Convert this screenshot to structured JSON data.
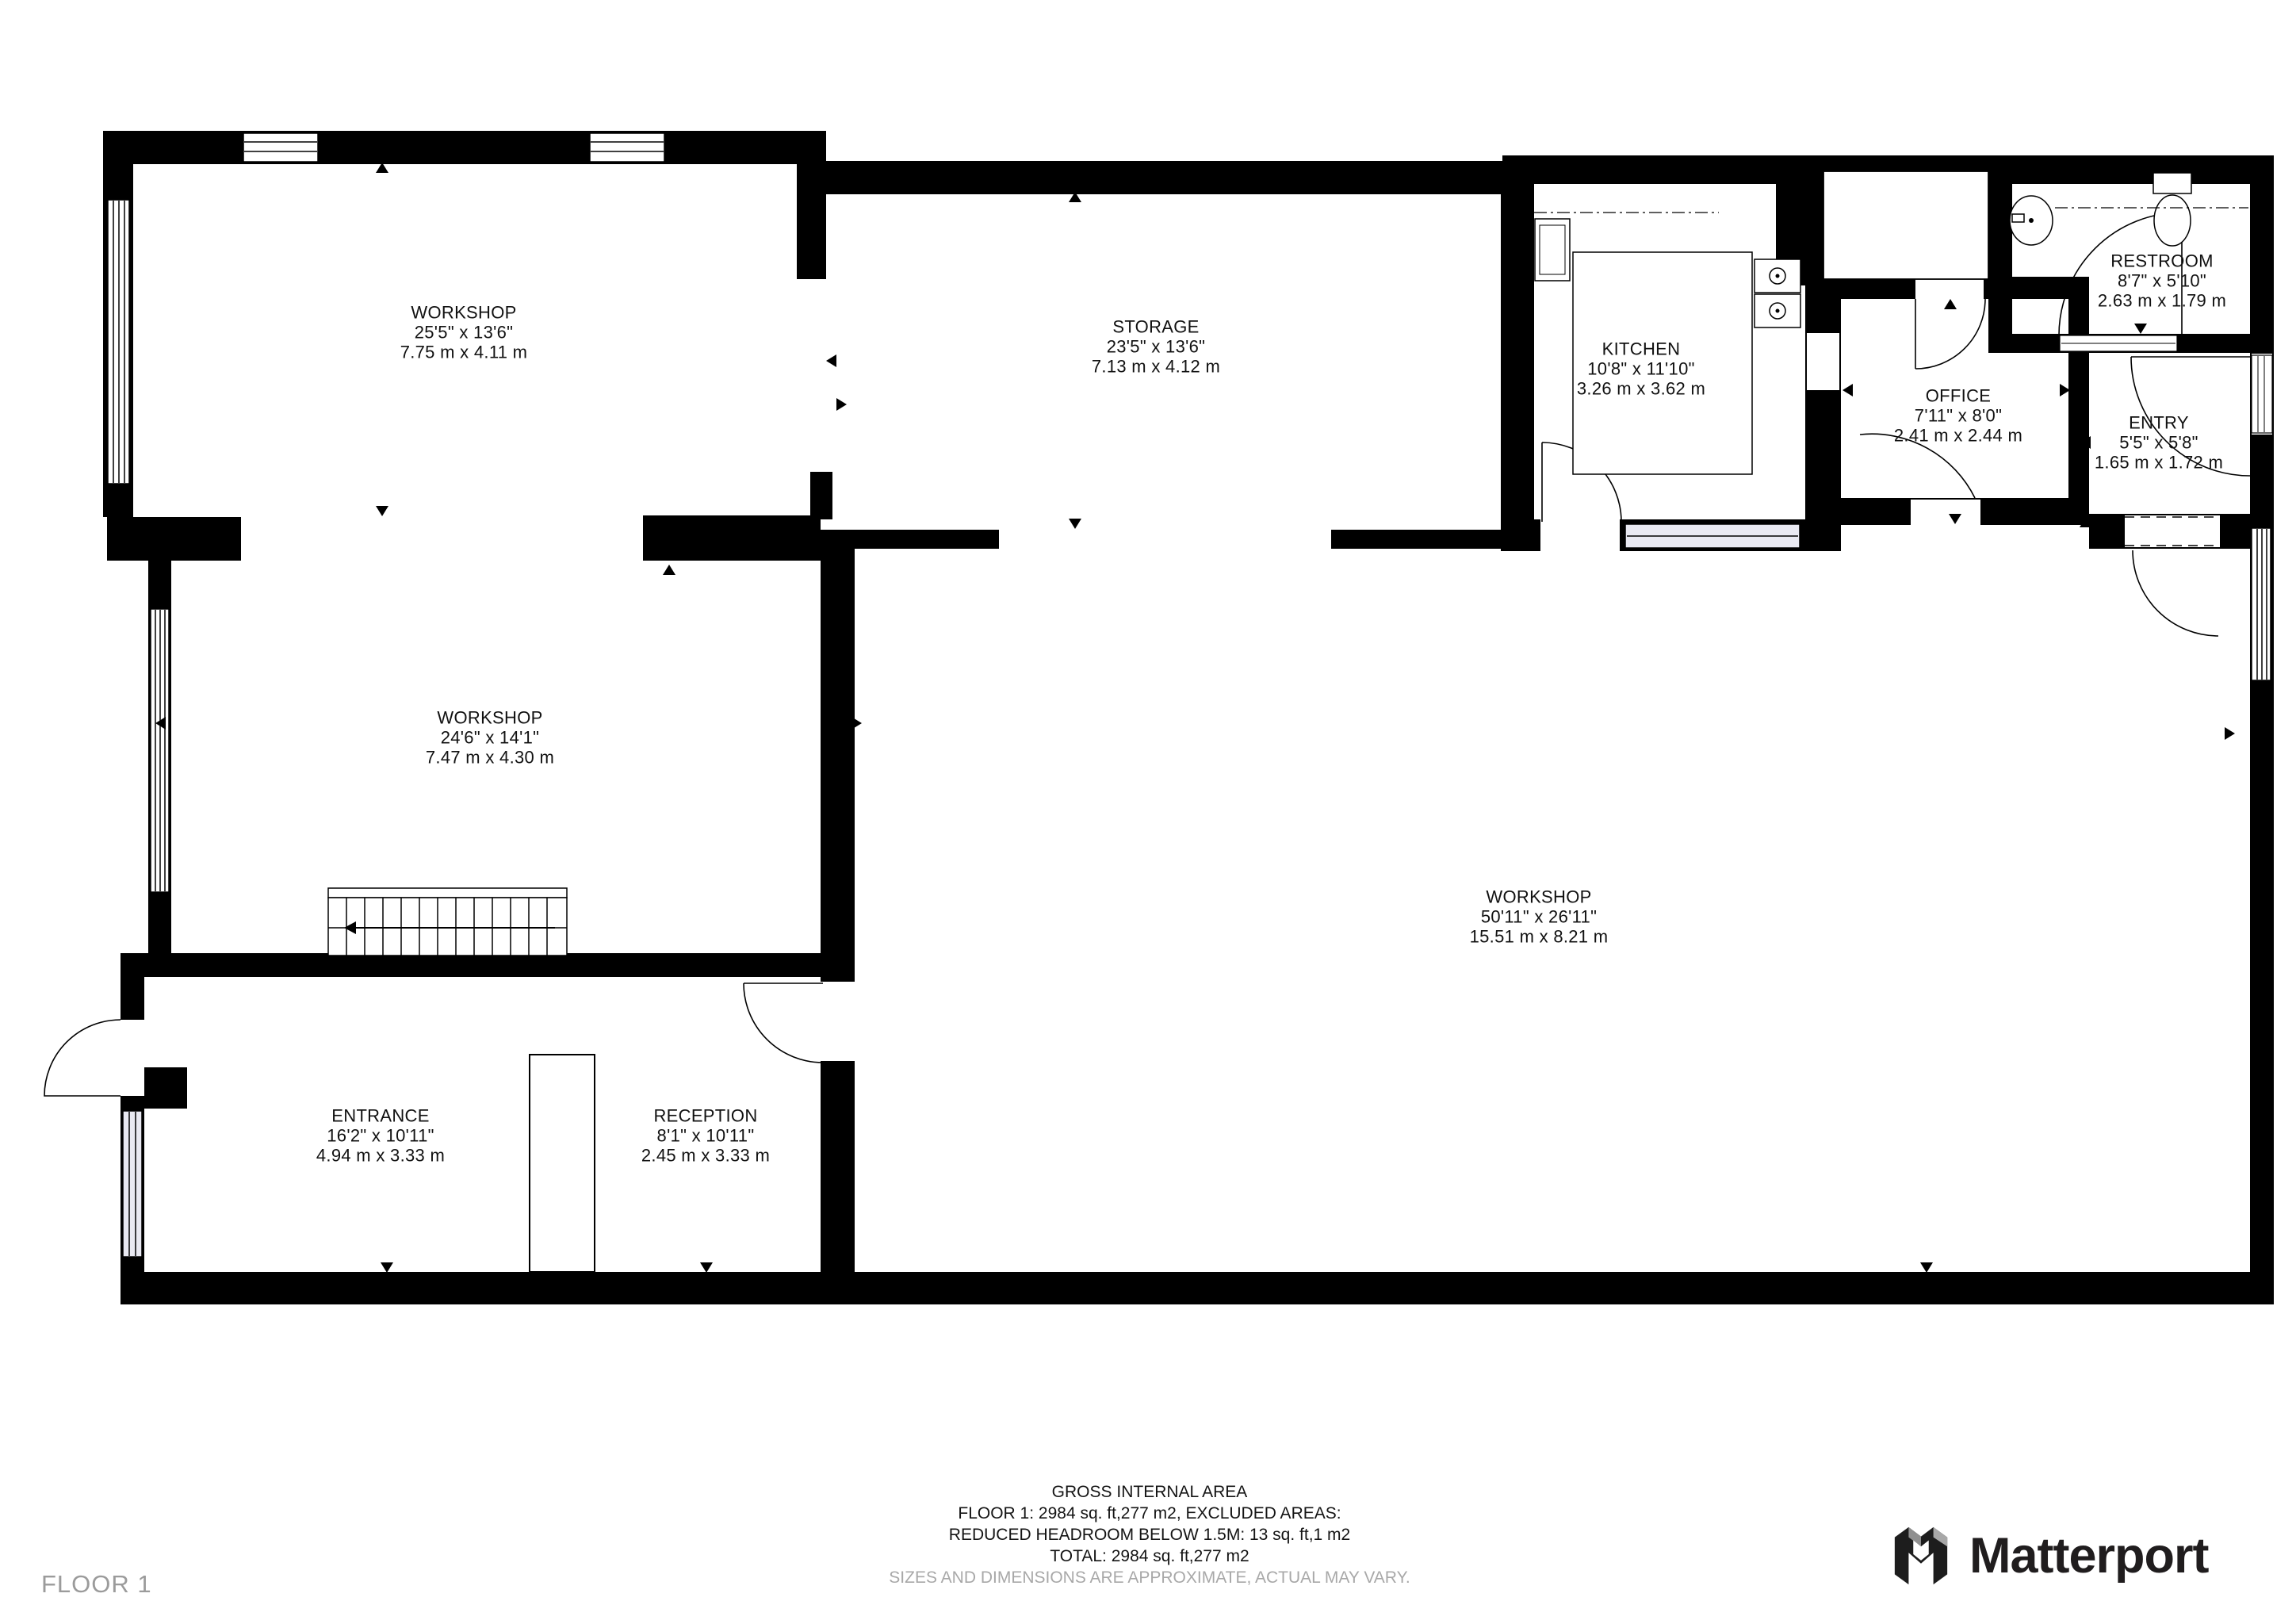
{
  "floor_label": "FLOOR 1",
  "brand": {
    "name": "Matterport"
  },
  "rooms": [
    {
      "name": "WORKSHOP",
      "imperial": "25'5\" x 13'6\"",
      "metric": "7.75 m x 4.11 m"
    },
    {
      "name": "STORAGE",
      "imperial": "23'5\" x 13'6\"",
      "metric": "7.13 m x 4.12 m"
    },
    {
      "name": "KITCHEN",
      "imperial": "10'8\" x 11'10\"",
      "metric": "3.26 m x 3.62 m"
    },
    {
      "name": "OFFICE",
      "imperial": "7'11\" x 8'0\"",
      "metric": "2.41 m x 2.44 m"
    },
    {
      "name": "RESTROOM",
      "imperial": "8'7\" x 5'10\"",
      "metric": "2.63 m x 1.79 m"
    },
    {
      "name": "ENTRY",
      "imperial": "5'5\" x 5'8\"",
      "metric": "1.65 m x 1.72 m"
    },
    {
      "name": "WORKSHOP",
      "imperial": "24'6\" x 14'1\"",
      "metric": "7.47 m x 4.30 m"
    },
    {
      "name": "WORKSHOP",
      "imperial": "50'11\" x 26'11\"",
      "metric": "15.51 m x 8.21 m"
    },
    {
      "name": "ENTRANCE",
      "imperial": "16'2\" x 10'11\"",
      "metric": "4.94 m x 3.33 m"
    },
    {
      "name": "RECEPTION",
      "imperial": "8'1\" x 10'11\"",
      "metric": "2.45 m x 3.33 m"
    }
  ],
  "footer": {
    "line1": "GROSS INTERNAL AREA",
    "line2": "FLOOR 1: 2984 sq. ft,277 m2, EXCLUDED AREAS:",
    "line3": "REDUCED HEADROOM BELOW 1.5M: 13 sq. ft,1 m2",
    "line4": "TOTAL: 2984 sq. ft,277 m2",
    "disclaimer": "SIZES AND DIMENSIONS ARE APPROXIMATE, ACTUAL MAY VARY."
  },
  "colors": {
    "wall": "#000000",
    "window_tint": "#e9e9f2",
    "muted_text": "#9b9b9b",
    "brand_text": "#201d1e"
  }
}
